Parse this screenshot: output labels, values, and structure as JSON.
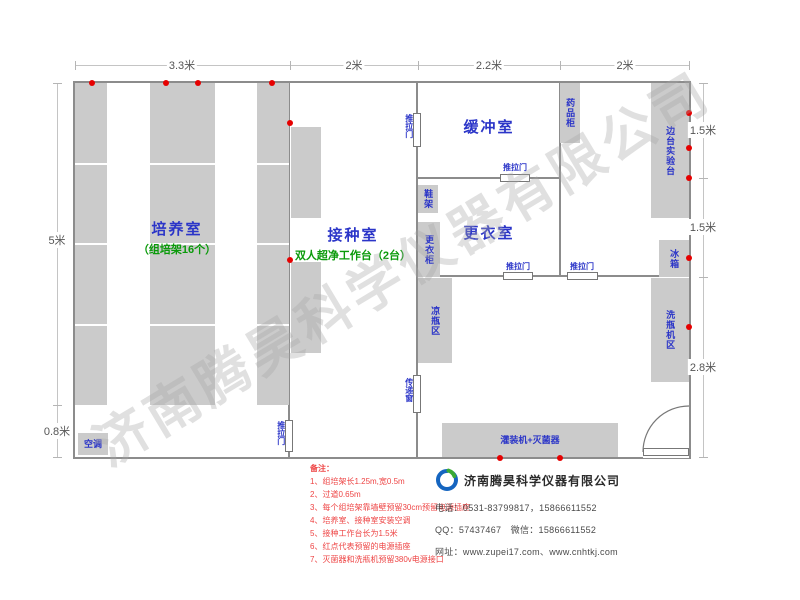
{
  "watermark": "济南腾昊科学仪器有限公司",
  "colors": {
    "wall_gray": "#8c8c8c",
    "furniture_gray": "#cbcbcb",
    "label_blue": "#2b35c8",
    "label_green": "#0a9a0a",
    "outlet_red": "#e60000",
    "note_red": "#ee4545",
    "dim_gray": "#555555",
    "logo_blue": "#1565c0",
    "logo_green": "#3aaa35"
  },
  "plan": {
    "outer": {
      "x": 75,
      "y": 83,
      "w": 614,
      "h": 374
    },
    "walls": [
      {
        "name": "wall-cultivation-inoculation",
        "x": 288,
        "y": 83,
        "w": 2,
        "h": 374
      },
      {
        "name": "wall-inoculation-right",
        "x": 416,
        "y": 83,
        "w": 2,
        "h": 374
      },
      {
        "name": "wall-buffer-rightroom",
        "x": 559,
        "y": 83,
        "w": 2,
        "h": 194
      },
      {
        "name": "wall-buffer-bottom",
        "x": 418,
        "y": 177,
        "w": 141,
        "h": 2
      },
      {
        "name": "wall-dressing-bottom",
        "x": 418,
        "y": 275,
        "w": 271,
        "h": 2
      }
    ],
    "rooms": [
      {
        "label": "培养室",
        "sub": "（组培架16个）",
        "cx": 177,
        "y": 218
      },
      {
        "label": "接种室",
        "sub": "双人超净工作台（2台）",
        "cx": 353,
        "y": 224
      },
      {
        "label": "缓冲室",
        "sub": "",
        "cx": 489,
        "y": 116
      },
      {
        "label": "更衣室",
        "sub": "",
        "cx": 489,
        "y": 222
      }
    ],
    "furniture": [
      {
        "name": "culture-rack-1",
        "label": "",
        "x": 75,
        "y": 83,
        "w": 32,
        "h": 322,
        "orient": "v",
        "striped": true
      },
      {
        "name": "culture-rack-2",
        "label": "",
        "x": 150,
        "y": 83,
        "w": 65,
        "h": 322,
        "orient": "v",
        "striped": true
      },
      {
        "name": "culture-rack-3",
        "label": "",
        "x": 257,
        "y": 83,
        "w": 32,
        "h": 322,
        "orient": "v",
        "striped": true
      },
      {
        "name": "air-conditioner",
        "label": "空调",
        "x": 78,
        "y": 433,
        "w": 30,
        "h": 22,
        "orient": "h",
        "striped": false
      },
      {
        "name": "clean-bench-1",
        "label": "",
        "x": 291,
        "y": 127,
        "w": 30,
        "h": 91,
        "orient": "v",
        "striped": false
      },
      {
        "name": "clean-bench-2",
        "label": "",
        "x": 291,
        "y": 262,
        "w": 30,
        "h": 91,
        "orient": "v",
        "striped": false
      },
      {
        "name": "shoe-rack",
        "label": "鞋架",
        "x": 418,
        "y": 185,
        "w": 20,
        "h": 28,
        "orient": "v",
        "striped": false
      },
      {
        "name": "wardrobe-cabinet",
        "label": "更衣柜",
        "x": 418,
        "y": 222,
        "w": 22,
        "h": 55,
        "orient": "v",
        "striped": false
      },
      {
        "name": "bottle-cooling-area",
        "label": "凉瓶区",
        "x": 418,
        "y": 278,
        "w": 34,
        "h": 85,
        "orient": "v",
        "striped": false
      },
      {
        "name": "medicine-cabinet",
        "label": "药品柜",
        "x": 560,
        "y": 83,
        "w": 20,
        "h": 60,
        "orient": "v",
        "striped": false
      },
      {
        "name": "side-lab-bench",
        "label": "边台实验台",
        "x": 651,
        "y": 83,
        "w": 38,
        "h": 135,
        "orient": "v",
        "striped": false
      },
      {
        "name": "fridge",
        "label": "冰箱",
        "x": 659,
        "y": 240,
        "w": 30,
        "h": 37,
        "orient": "v",
        "striped": false
      },
      {
        "name": "bottle-washer-area",
        "label": "洗瓶机区",
        "x": 651,
        "y": 278,
        "w": 38,
        "h": 104,
        "orient": "v",
        "striped": false
      },
      {
        "name": "filling-machine-sterilizer",
        "label": "灌装机+灭菌器",
        "x": 442,
        "y": 423,
        "w": 176,
        "h": 34,
        "orient": "h",
        "striped": false
      }
    ],
    "doors": [
      {
        "name": "sliding-door-cultivation",
        "label": "推拉门",
        "x": 285,
        "y": 420,
        "w": 8,
        "h": 32,
        "lx": 276,
        "ly": 421,
        "lo": "v"
      },
      {
        "name": "sliding-door-buffer",
        "label": "推拉门",
        "x": 413,
        "y": 113,
        "w": 8,
        "h": 34,
        "lx": 404,
        "ly": 114,
        "lo": "v"
      },
      {
        "name": "pass-window",
        "label": "传递窗",
        "x": 413,
        "y": 375,
        "w": 8,
        "h": 38,
        "lx": 404,
        "ly": 378,
        "lo": "v"
      },
      {
        "name": "sliding-door-buffer-dressing",
        "label": "推拉门",
        "x": 500,
        "y": 174,
        "w": 30,
        "h": 8,
        "lx": 493,
        "ly": 164,
        "lo": "h"
      },
      {
        "name": "sliding-door-dressing-work",
        "label": "推拉门",
        "x": 503,
        "y": 272,
        "w": 30,
        "h": 8,
        "lx": 496,
        "ly": 263,
        "lo": "h"
      },
      {
        "name": "sliding-door-rightroom-work",
        "label": "推拉门",
        "x": 567,
        "y": 272,
        "w": 31,
        "h": 8,
        "lx": 560,
        "ly": 263,
        "lo": "h"
      }
    ],
    "outlets": [
      [
        92,
        83
      ],
      [
        166,
        83
      ],
      [
        198,
        83
      ],
      [
        272,
        83
      ],
      [
        290,
        123
      ],
      [
        290,
        260
      ],
      [
        689,
        113
      ],
      [
        689,
        148
      ],
      [
        689,
        178
      ],
      [
        689,
        258
      ],
      [
        689,
        327
      ],
      [
        500,
        458
      ],
      [
        560,
        458
      ]
    ],
    "dims": {
      "top": {
        "axis": "h",
        "line": {
          "x": 75,
          "y": 65,
          "len": 614
        },
        "ticks": [
          75,
          290,
          418,
          560,
          689
        ],
        "labels": [
          {
            "text": "3.3米",
            "pos": 182
          },
          {
            "text": "2米",
            "pos": 354
          },
          {
            "text": "2.2米",
            "pos": 489
          },
          {
            "text": "2米",
            "pos": 625
          }
        ]
      },
      "left": {
        "axis": "v",
        "line": {
          "x": 57,
          "y": 83,
          "len": 374
        },
        "ticks": [
          83,
          405,
          457
        ],
        "labels": [
          {
            "text": "5米",
            "pos": 240
          },
          {
            "text": "0.8米",
            "pos": 431
          }
        ]
      },
      "right": {
        "axis": "v",
        "line": {
          "x": 703,
          "y": 83,
          "len": 374
        },
        "ticks": [
          83,
          178,
          277,
          457
        ],
        "labels": [
          {
            "text": "1.5米",
            "pos": 130
          },
          {
            "text": "1.5米",
            "pos": 227
          },
          {
            "text": "2.8米",
            "pos": 367
          }
        ]
      }
    }
  },
  "notes": {
    "title": "备注：",
    "items": [
      "1、组培架长1.25m,宽0.5m",
      "2、过道0.65m",
      "3、每个组培架靠墙壁预留30cm预留电源插座",
      "4、培养室、接种室安装空调",
      "5、接种工作台长为1.5米",
      "6、红点代表预留的电源插座",
      "7、灭菌器和洗瓶机预留380v电源接口"
    ]
  },
  "company": {
    "name": "济南腾昊科学仪器有限公司",
    "phone": "电话：0531-83799817，15866611552",
    "qq": "QQ：57437467　微信：15866611552",
    "web": "网址：www.zupei17.com、www.cnhtkj.com"
  }
}
